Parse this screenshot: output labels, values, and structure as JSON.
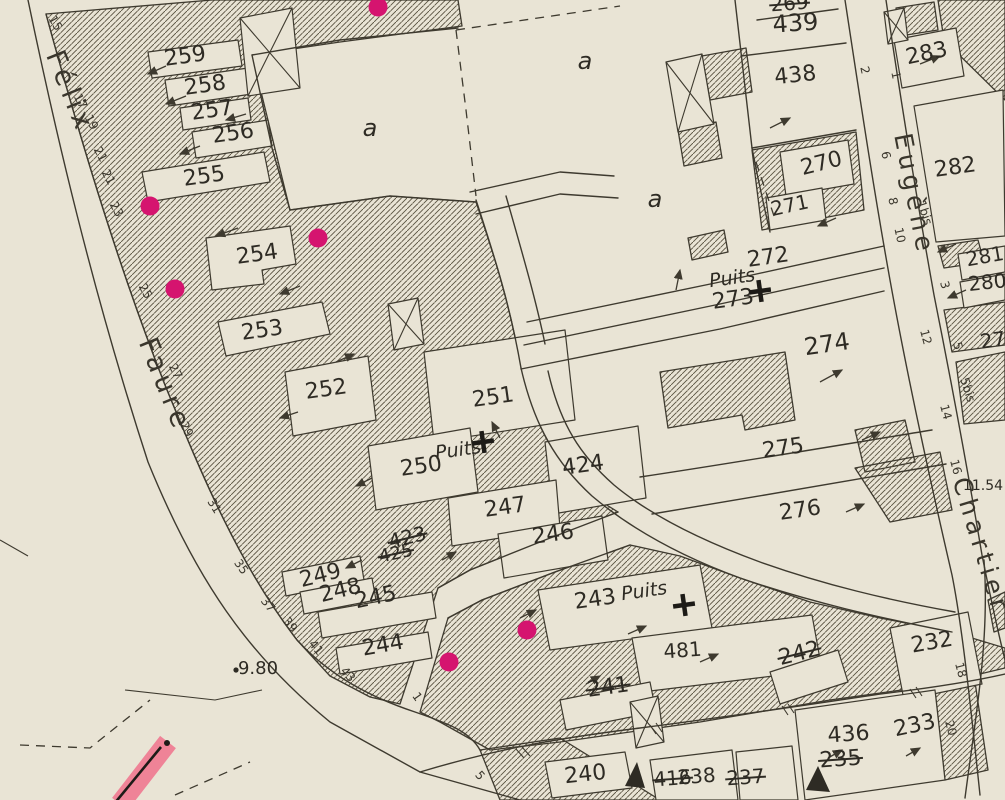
{
  "map": {
    "colors": {
      "paper": "#e9e4d5",
      "ink": "#3e3a2f",
      "magenta_dot": "#d5146f",
      "pink_highlight": "#ef8397"
    },
    "street_names": [
      {
        "text": "Félix",
        "x": 62,
        "y": 95,
        "rot": 68,
        "size": 27
      },
      {
        "text": "Faure",
        "x": 157,
        "y": 388,
        "rot": 68,
        "size": 27
      },
      {
        "text": "Eugène",
        "x": 906,
        "y": 196,
        "rot": 79,
        "size": 25
      },
      {
        "text": "Chartier",
        "x": 973,
        "y": 548,
        "rot": 73,
        "size": 25
      }
    ],
    "area_labels": [
      {
        "text": "a",
        "x": 370,
        "y": 136
      },
      {
        "text": "a",
        "x": 585,
        "y": 69
      },
      {
        "text": "a",
        "x": 655,
        "y": 207
      }
    ],
    "parcel_labels": [
      {
        "text": "259",
        "x": 186,
        "y": 63,
        "rot": -8,
        "size": 22,
        "struck": false
      },
      {
        "text": "258",
        "x": 206,
        "y": 92,
        "rot": -8,
        "size": 22,
        "struck": false
      },
      {
        "text": "257",
        "x": 213,
        "y": 117,
        "rot": -8,
        "size": 22,
        "struck": false
      },
      {
        "text": "256",
        "x": 234,
        "y": 140,
        "rot": -8,
        "size": 22,
        "struck": false
      },
      {
        "text": "255",
        "x": 205,
        "y": 183,
        "rot": -8,
        "size": 22,
        "struck": false
      },
      {
        "text": "254",
        "x": 258,
        "y": 261,
        "rot": -8,
        "size": 22,
        "struck": false
      },
      {
        "text": "253",
        "x": 263,
        "y": 337,
        "rot": -8,
        "size": 22,
        "struck": false
      },
      {
        "text": "252",
        "x": 327,
        "y": 396,
        "rot": -8,
        "size": 22,
        "struck": false
      },
      {
        "text": "251",
        "x": 494,
        "y": 404,
        "rot": -8,
        "size": 22,
        "struck": false
      },
      {
        "text": "250",
        "x": 422,
        "y": 473,
        "rot": -8,
        "size": 22,
        "struck": false
      },
      {
        "text": "424",
        "x": 584,
        "y": 472,
        "rot": -8,
        "size": 22,
        "struck": false
      },
      {
        "text": "247",
        "x": 506,
        "y": 514,
        "rot": -8,
        "size": 22,
        "struck": false
      },
      {
        "text": "246",
        "x": 554,
        "y": 541,
        "rot": -8,
        "size": 22,
        "struck": false
      },
      {
        "text": "249",
        "x": 322,
        "y": 582,
        "rot": -14,
        "size": 22,
        "struck": false
      },
      {
        "text": "248",
        "x": 342,
        "y": 597,
        "rot": -14,
        "size": 22,
        "struck": false
      },
      {
        "text": "245",
        "x": 377,
        "y": 604,
        "rot": -12,
        "size": 22,
        "struck": false
      },
      {
        "text": "244",
        "x": 384,
        "y": 652,
        "rot": -10,
        "size": 22,
        "struck": false
      },
      {
        "text": "243",
        "x": 596,
        "y": 606,
        "rot": -8,
        "size": 22,
        "struck": false
      },
      {
        "text": "481",
        "x": 683,
        "y": 657,
        "rot": -4,
        "size": 20,
        "struck": false
      },
      {
        "text": "241",
        "x": 609,
        "y": 694,
        "rot": -8,
        "size": 22,
        "struck": true
      },
      {
        "text": "240",
        "x": 586,
        "y": 781,
        "rot": -6,
        "size": 22,
        "struck": false
      },
      {
        "text": "242",
        "x": 801,
        "y": 660,
        "rot": -14,
        "size": 22,
        "struck": true
      },
      {
        "text": "232",
        "x": 933,
        "y": 649,
        "rot": -10,
        "size": 22,
        "struck": false
      },
      {
        "text": "233",
        "x": 916,
        "y": 732,
        "rot": -12,
        "size": 22,
        "struck": false
      },
      {
        "text": "436",
        "x": 849,
        "y": 741,
        "rot": -4,
        "size": 22,
        "struck": false
      },
      {
        "text": "235",
        "x": 841,
        "y": 766,
        "rot": -4,
        "size": 22,
        "struck": true
      },
      {
        "text": "416",
        "x": 673,
        "y": 785,
        "rot": -4,
        "size": 20,
        "struck": true
      },
      {
        "text": "238",
        "x": 697,
        "y": 783,
        "rot": -4,
        "size": 20,
        "struck": false
      },
      {
        "text": "237",
        "x": 746,
        "y": 784,
        "rot": -4,
        "size": 20,
        "struck": true
      },
      {
        "text": "274",
        "x": 828,
        "y": 352,
        "rot": -8,
        "size": 24,
        "struck": false
      },
      {
        "text": "275",
        "x": 784,
        "y": 455,
        "rot": -8,
        "size": 22,
        "struck": false
      },
      {
        "text": "276",
        "x": 801,
        "y": 517,
        "rot": -8,
        "size": 22,
        "struck": false
      },
      {
        "text": "272",
        "x": 769,
        "y": 264,
        "rot": -8,
        "size": 22,
        "struck": false
      },
      {
        "text": "273",
        "x": 734,
        "y": 306,
        "rot": -8,
        "size": 22,
        "struck": false
      },
      {
        "text": "270",
        "x": 823,
        "y": 170,
        "rot": -14,
        "size": 22,
        "struck": false
      },
      {
        "text": "271",
        "x": 791,
        "y": 212,
        "rot": -12,
        "size": 20,
        "struck": false
      },
      {
        "text": "438",
        "x": 796,
        "y": 82,
        "rot": -6,
        "size": 22,
        "struck": false
      },
      {
        "text": "439",
        "x": 796,
        "y": 31,
        "rot": -4,
        "size": 24,
        "struck": false
      },
      {
        "text": "269",
        "x": 790,
        "y": 10,
        "rot": -4,
        "size": 20,
        "struck": true
      },
      {
        "text": "283",
        "x": 928,
        "y": 60,
        "rot": -12,
        "size": 22,
        "struck": false
      },
      {
        "text": "282",
        "x": 956,
        "y": 174,
        "rot": -8,
        "size": 22,
        "struck": false
      },
      {
        "text": "281",
        "x": 986,
        "y": 263,
        "rot": -10,
        "size": 20,
        "struck": false
      },
      {
        "text": "280",
        "x": 988,
        "y": 289,
        "rot": -6,
        "size": 20,
        "struck": false
      },
      {
        "text": "279",
        "x": 1000,
        "y": 346,
        "rot": -8,
        "size": 20,
        "struck": false
      },
      {
        "text": "423",
        "x": 409,
        "y": 544,
        "rot": -14,
        "size": 20,
        "struck": true
      },
      {
        "text": "425",
        "x": 397,
        "y": 559,
        "rot": -12,
        "size": 18,
        "struck": true
      }
    ],
    "house_numbers": [
      {
        "text": "15",
        "x": 52,
        "y": 25,
        "rot": 60
      },
      {
        "text": "17",
        "x": 77,
        "y": 103,
        "rot": 62
      },
      {
        "text": "19",
        "x": 88,
        "y": 124,
        "rot": 62
      },
      {
        "text": "21",
        "x": 97,
        "y": 156,
        "rot": 62
      },
      {
        "text": "21",
        "x": 105,
        "y": 179,
        "rot": 62
      },
      {
        "text": "23",
        "x": 113,
        "y": 211,
        "rot": 62
      },
      {
        "text": "25",
        "x": 142,
        "y": 293,
        "rot": 62
      },
      {
        "text": "27",
        "x": 172,
        "y": 373,
        "rot": 64
      },
      {
        "text": "29",
        "x": 183,
        "y": 431,
        "rot": 64
      },
      {
        "text": "31",
        "x": 211,
        "y": 508,
        "rot": 58
      },
      {
        "text": "35",
        "x": 238,
        "y": 569,
        "rot": 55
      },
      {
        "text": "37",
        "x": 265,
        "y": 607,
        "rot": 52
      },
      {
        "text": "39",
        "x": 287,
        "y": 627,
        "rot": 52
      },
      {
        "text": "41",
        "x": 313,
        "y": 650,
        "rot": 50
      },
      {
        "text": "43",
        "x": 345,
        "y": 677,
        "rot": 48
      },
      {
        "text": "1",
        "x": 414,
        "y": 699,
        "rot": 55
      },
      {
        "text": "5",
        "x": 477,
        "y": 778,
        "rot": 50
      },
      {
        "text": "2",
        "x": 861,
        "y": 71,
        "rot": 78
      },
      {
        "text": "1",
        "x": 892,
        "y": 76,
        "rot": 78
      },
      {
        "text": "6",
        "x": 882,
        "y": 156,
        "rot": 78
      },
      {
        "text": "8",
        "x": 889,
        "y": 202,
        "rot": 78
      },
      {
        "text": "10",
        "x": 896,
        "y": 236,
        "rot": 78
      },
      {
        "text": "1bis",
        "x": 921,
        "y": 214,
        "rot": 72
      },
      {
        "text": "3",
        "x": 941,
        "y": 286,
        "rot": 75
      },
      {
        "text": "12",
        "x": 922,
        "y": 338,
        "rot": 75
      },
      {
        "text": "5",
        "x": 954,
        "y": 347,
        "rot": 75
      },
      {
        "text": "5bis",
        "x": 964,
        "y": 391,
        "rot": 72
      },
      {
        "text": "14",
        "x": 942,
        "y": 413,
        "rot": 75
      },
      {
        "text": "16",
        "x": 952,
        "y": 468,
        "rot": 75
      },
      {
        "text": "18",
        "x": 957,
        "y": 671,
        "rot": 75
      },
      {
        "text": "20",
        "x": 947,
        "y": 729,
        "rot": 75
      }
    ],
    "wells": [
      {
        "label": "Puits",
        "label_x": 459,
        "label_y": 456,
        "cross_x": 483,
        "cross_y": 442
      },
      {
        "label": "Puits",
        "label_x": 733,
        "label_y": 284,
        "cross_x": 760,
        "cross_y": 291
      },
      {
        "label": "Puits",
        "label_x": 645,
        "label_y": 597,
        "cross_x": 684,
        "cross_y": 605
      }
    ],
    "elevations": [
      {
        "text": "9.80",
        "x": 258,
        "y": 674,
        "size": 18,
        "dot": true
      },
      {
        "text": "11.54",
        "x": 983,
        "y": 490,
        "size": 14,
        "dot": false
      }
    ],
    "survey_dots": [
      {
        "x": 150,
        "y": 206
      },
      {
        "x": 318,
        "y": 238
      },
      {
        "x": 175,
        "y": 289
      },
      {
        "x": 378,
        "y": 7
      },
      {
        "x": 527,
        "y": 630
      },
      {
        "x": 449,
        "y": 662
      }
    ]
  }
}
